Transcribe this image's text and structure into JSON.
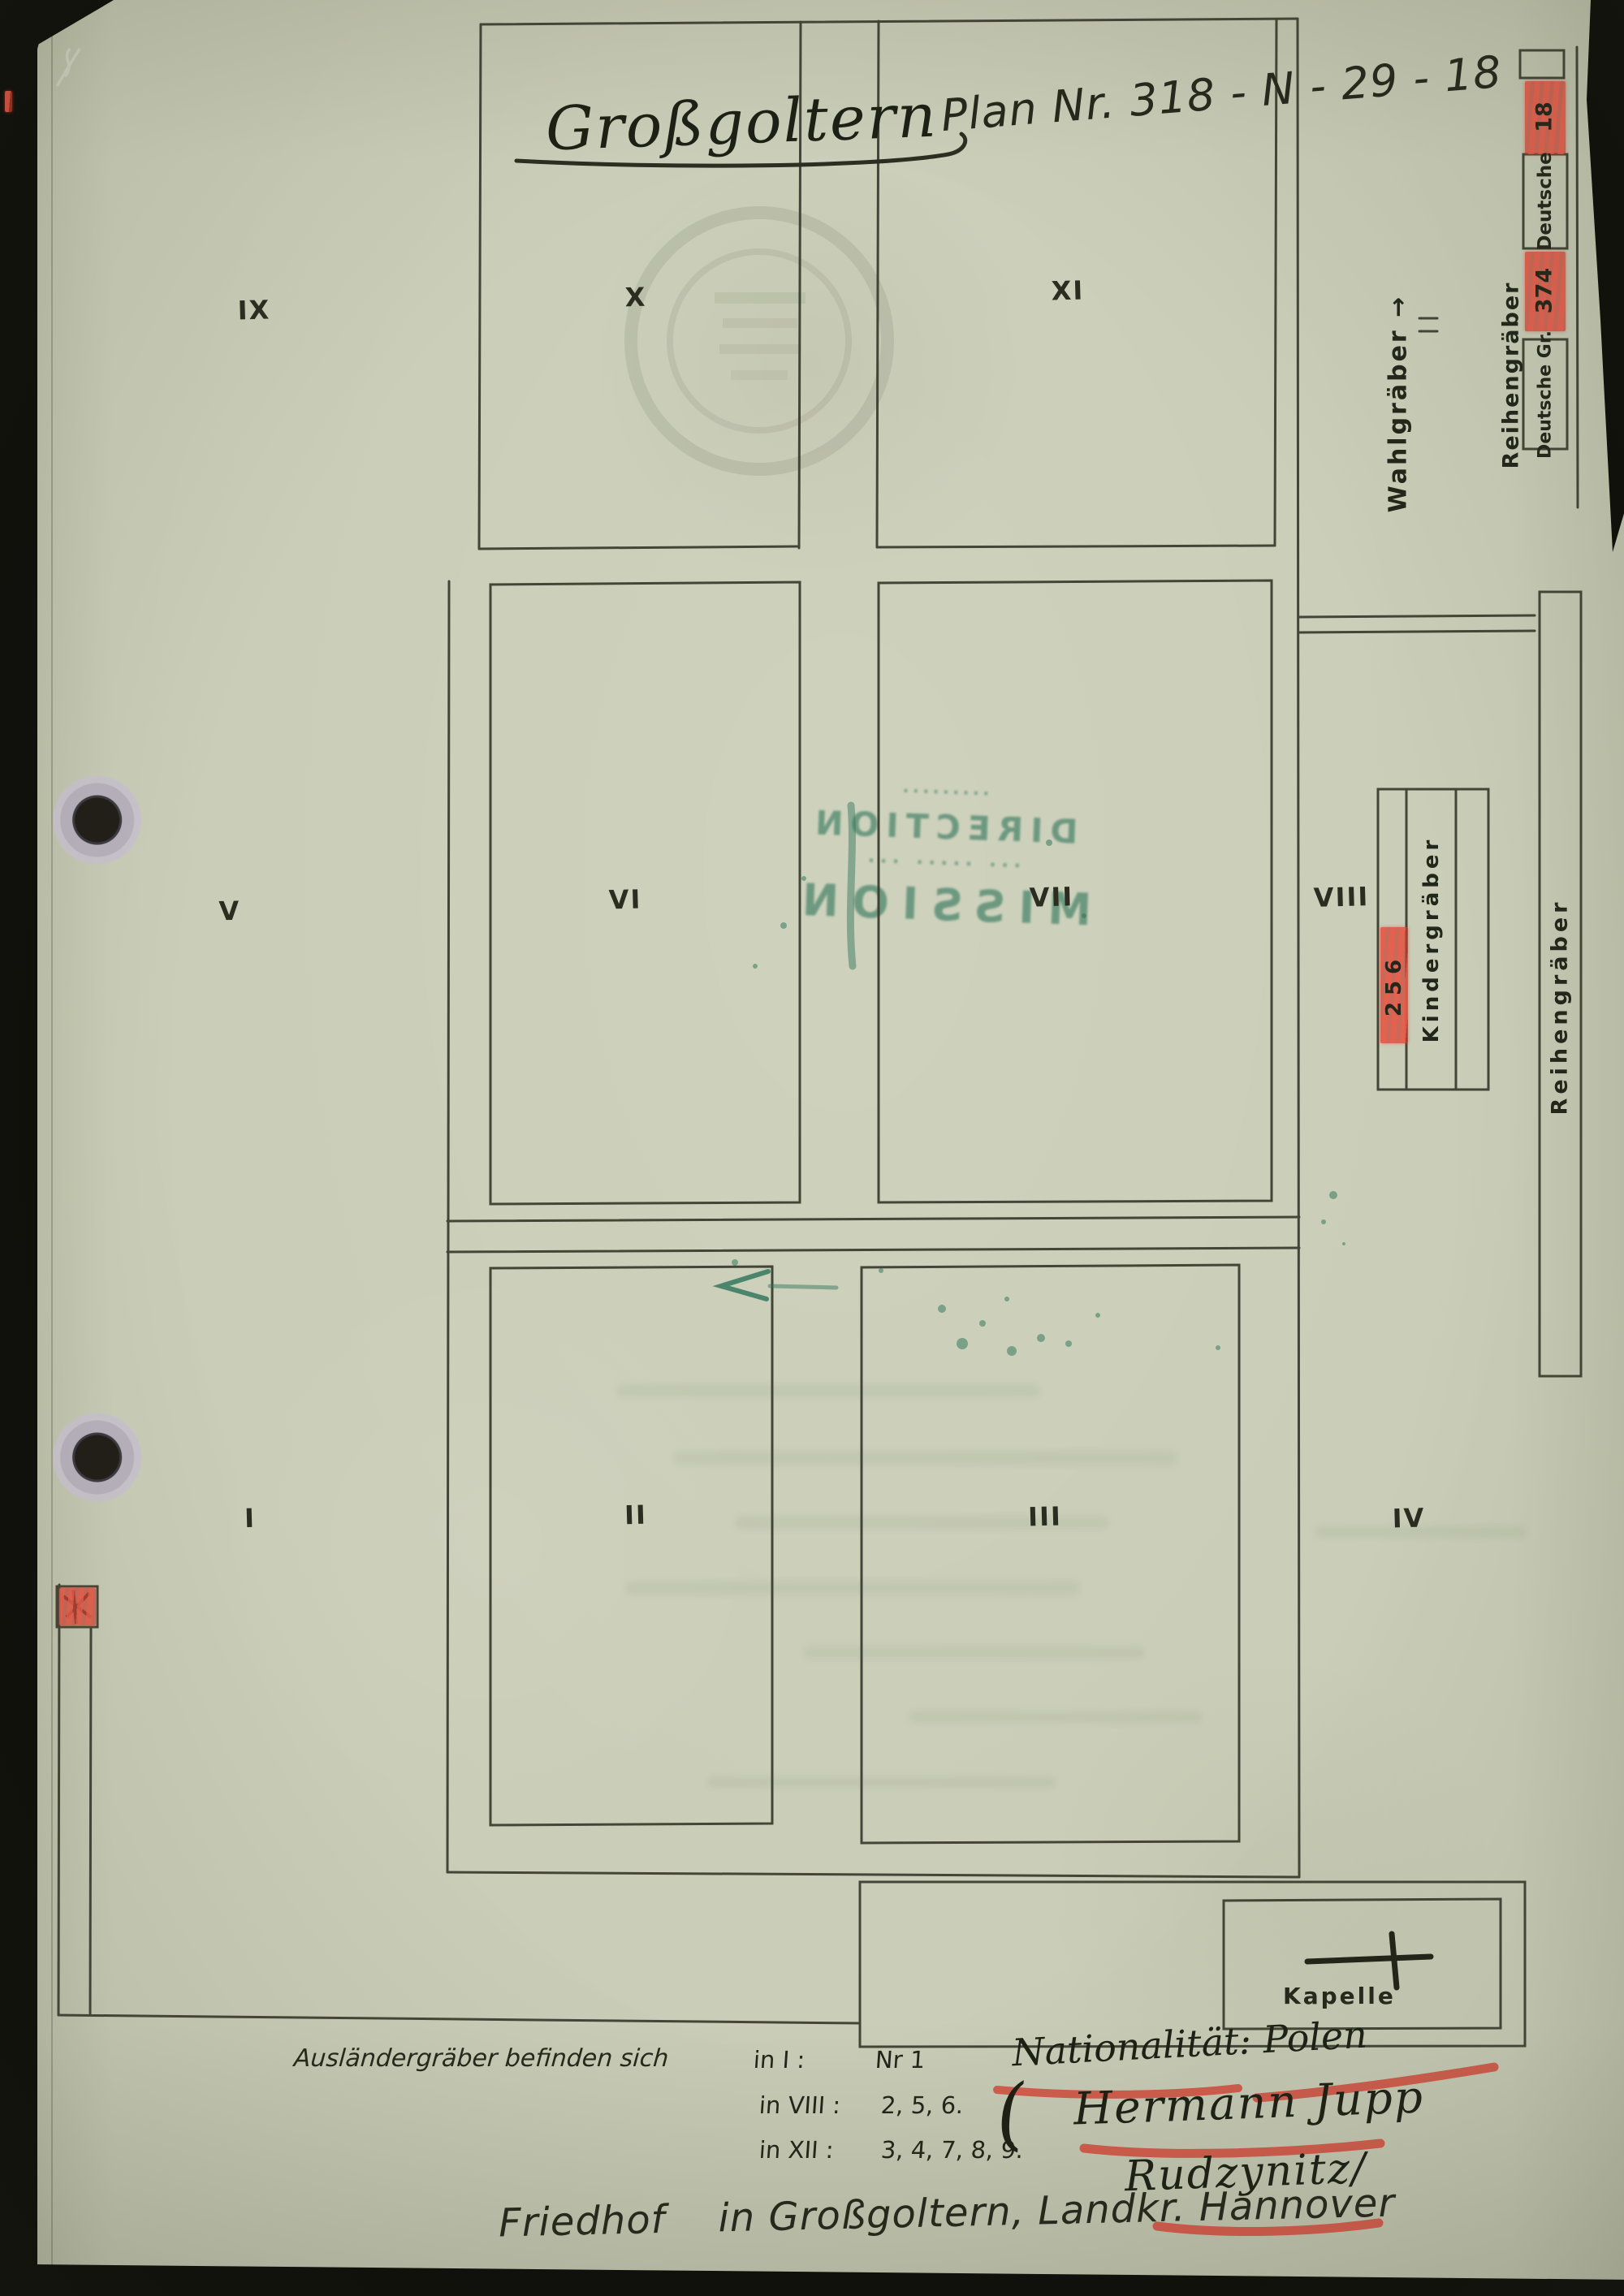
{
  "page": {
    "title": "Großgoltern",
    "plan_no": "Plan Nr. 318 - N - 29 - 18",
    "footer": "Friedhof    in Großgoltern, Landkr. Hannover"
  },
  "plots": {
    "ix": "IX",
    "x": "X",
    "xi": "XI",
    "v": "V",
    "vi": "VI",
    "vii": "VII",
    "viii": "VIII",
    "i": "I",
    "ii": "II",
    "iii": "III",
    "iv": "IV"
  },
  "margins": {
    "wahlgraeber": "Wahlgräber",
    "wahlgraeber_arrow": "→",
    "reihengraeber_top": "Reihengräber",
    "reihengraeber_right": "Reihengräber",
    "deutsche_label": "Deutsche",
    "deutsche_count": "18",
    "deutsche_gr_label": "Deutsche Gr.",
    "deutsche_gr_count": "374",
    "kindergraeber_label": "Kindergräber",
    "kindergraeber_count": "256",
    "kapelle_label": "Kapelle"
  },
  "notes": {
    "intro": "Ausländergräber befinden sich",
    "rows": [
      {
        "where": "in I :",
        "val": "Nr 1"
      },
      {
        "where": "in VIII :",
        "val": "2, 5, 6."
      },
      {
        "where": "in XII :",
        "val": "3, 4, 7, 8, 9."
      }
    ]
  },
  "handwriting": {
    "nationality": "Nationalität: Polen",
    "paren": "(",
    "name_1": "Hermann Jupp",
    "name_2": "Rudzynitz/"
  },
  "stamp": {
    "lines": [
      "·········",
      "DIRECTION",
      "··· ····· ···",
      "MISSION"
    ]
  },
  "colors": {
    "paper": "#c9cdb7",
    "ink": "#32342a",
    "red": "#d14536",
    "green": "#2a7257",
    "edge_black": "#0e0e0a"
  }
}
